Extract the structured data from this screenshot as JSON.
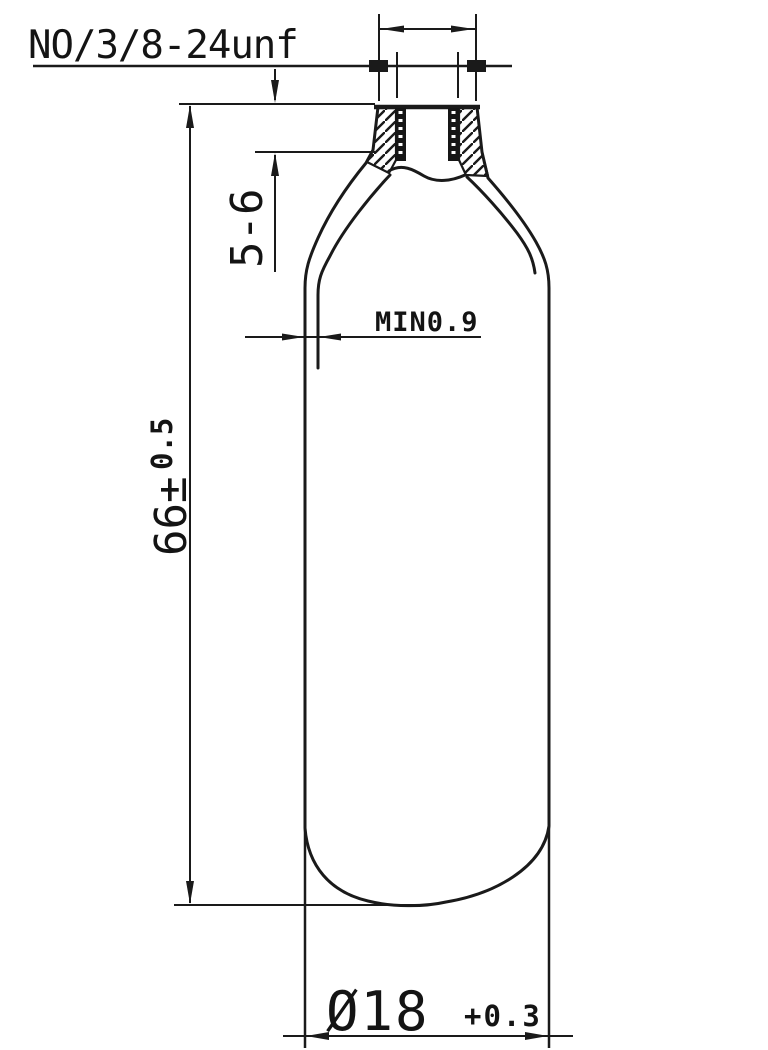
{
  "drawing": {
    "description": "CO2 cartridge cylinder cross-section technical drawing",
    "colors": {
      "background": "#ffffff",
      "line": "#1a1a1a"
    },
    "labels": {
      "thread_spec": "NO/3/8-24unf",
      "neck_length": "5-6",
      "wall_thickness": "MIN0.9",
      "overall_height_value": "66±",
      "overall_height_tolerance": "0.5",
      "diameter_value": "Ø18",
      "diameter_tolerance": "+0.3"
    }
  }
}
